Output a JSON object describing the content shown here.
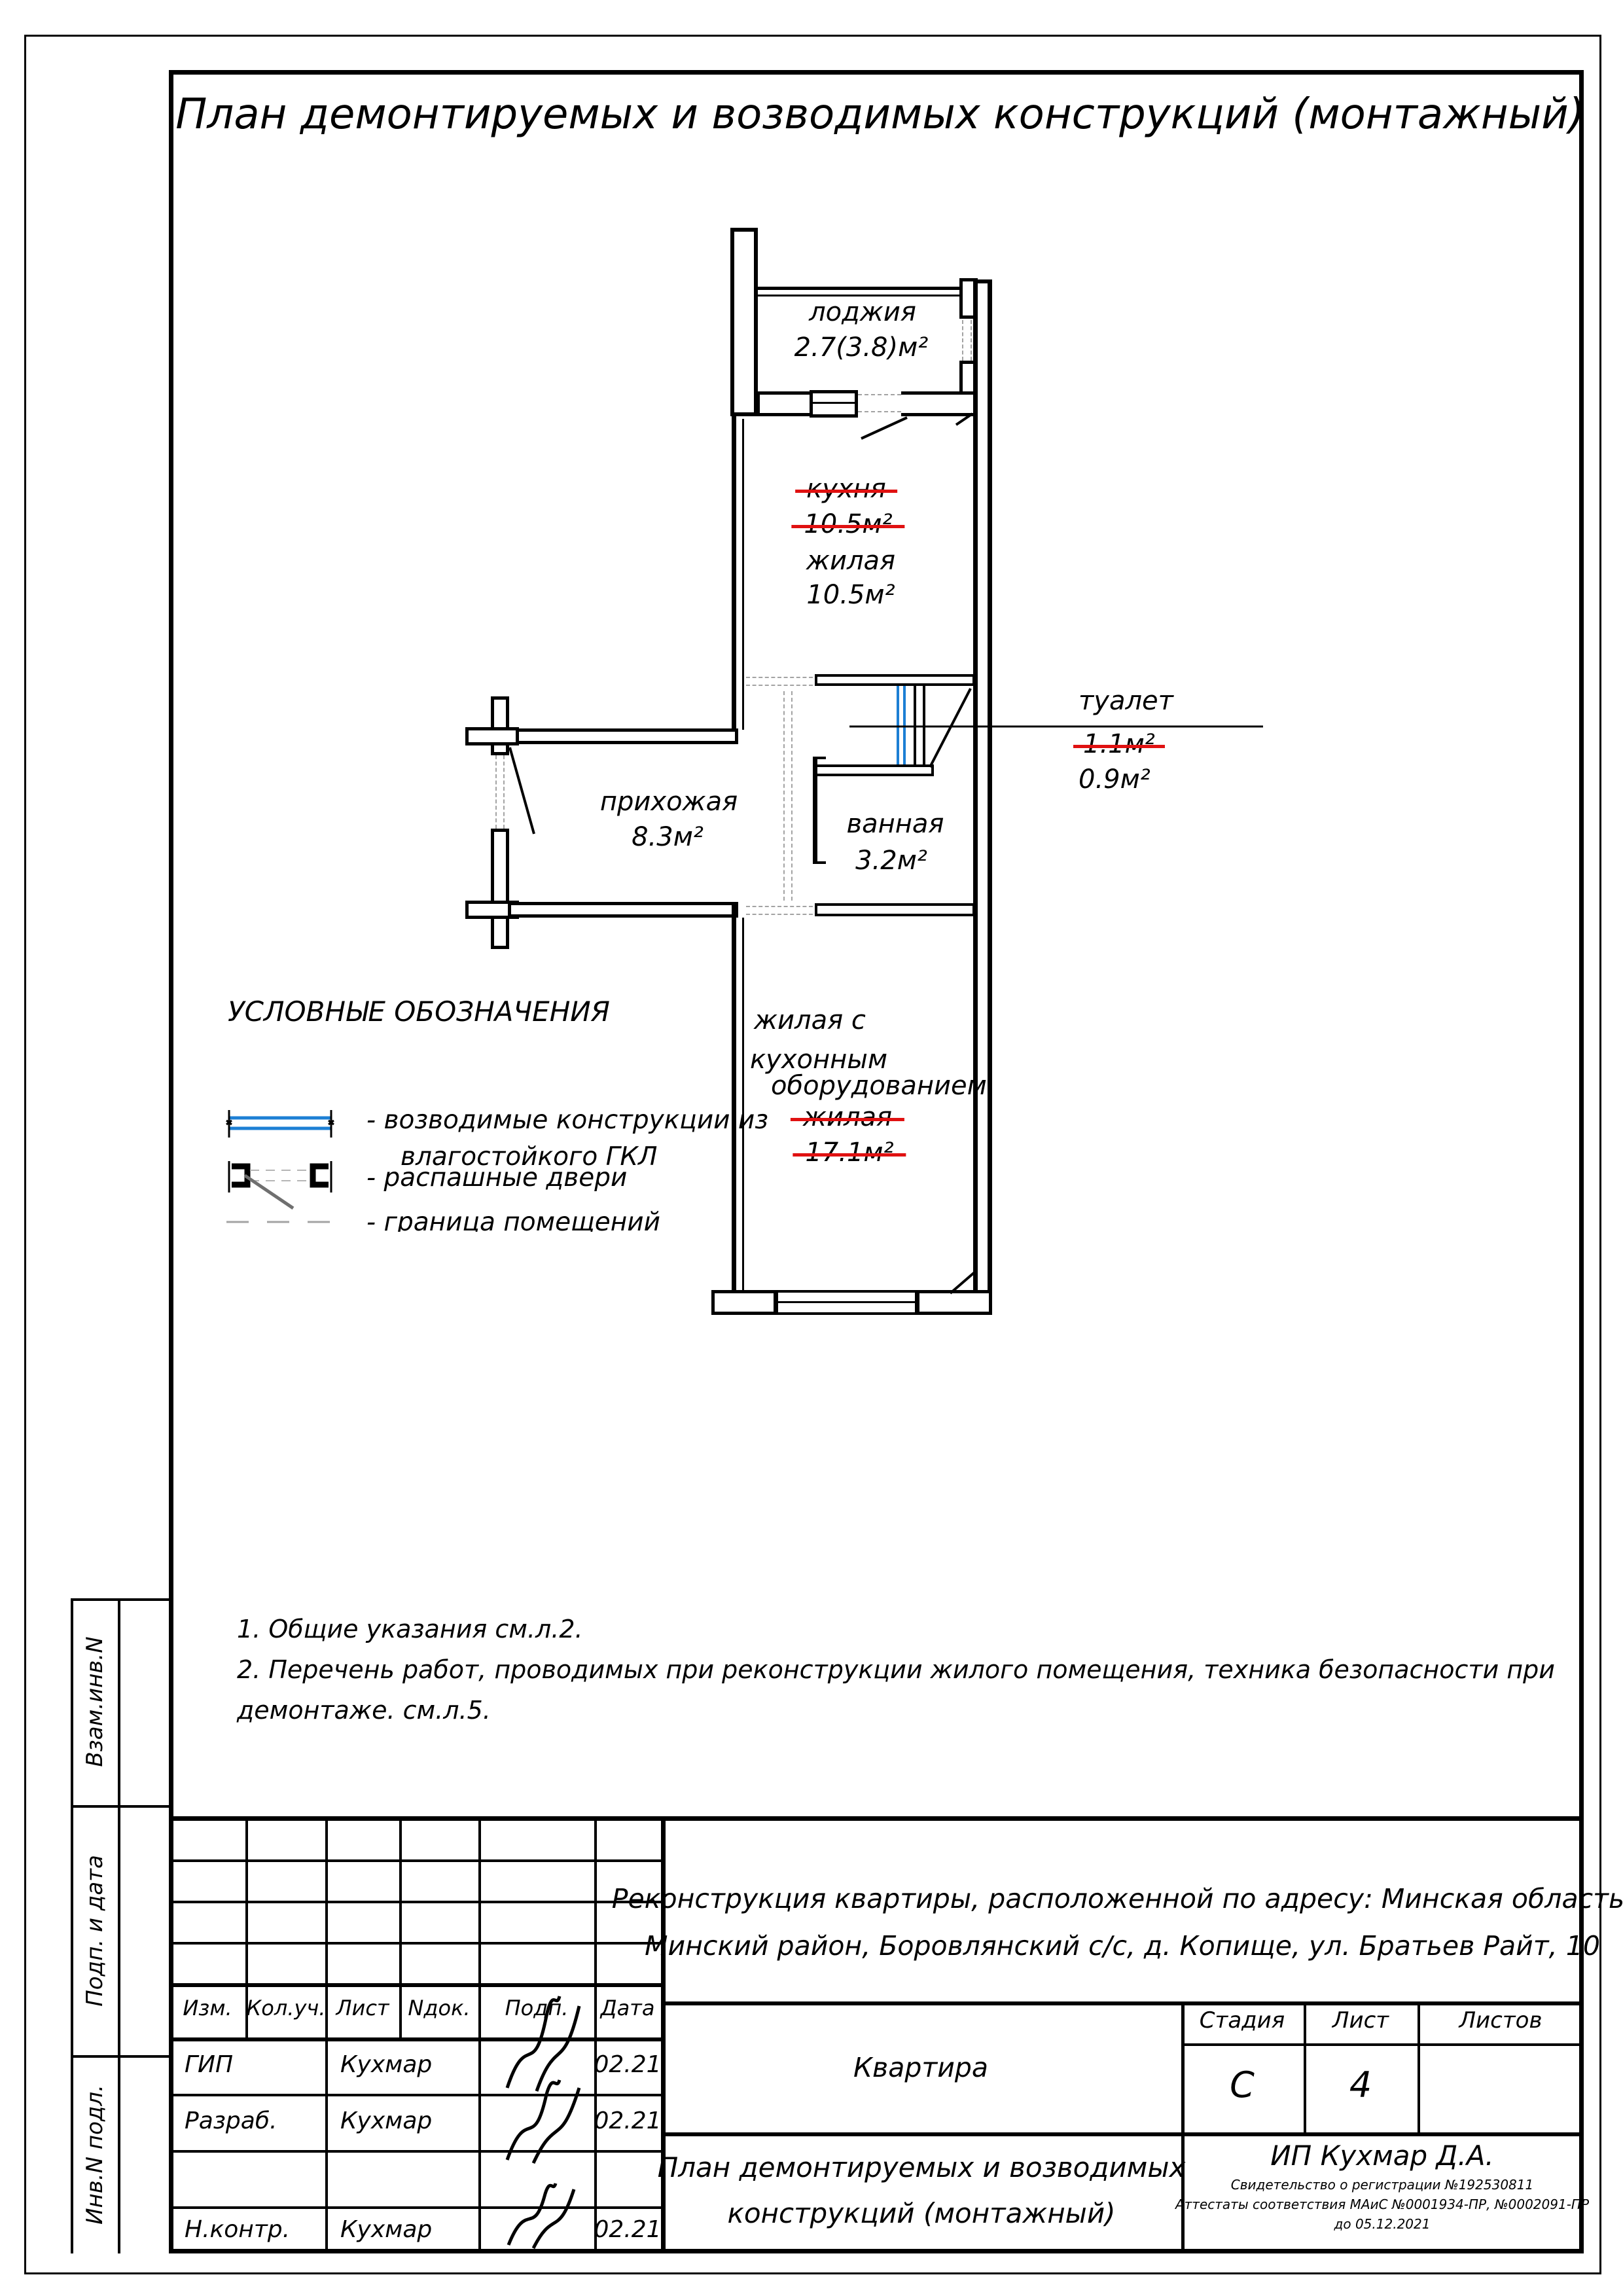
{
  "title": "План демонтируемых и возводимых конструкций (монтажный)",
  "plan": {
    "rooms": {
      "loggia": {
        "name": "лоджия",
        "area": "2.7(3.8)м²"
      },
      "kitchen_old": {
        "name": "кухня",
        "area": "10.5м²"
      },
      "living_new": {
        "name": "жилая",
        "area": "10.5м²"
      },
      "toilet": {
        "name": "туалет",
        "area_old": "1.1м²",
        "area_new": "0.9м²"
      },
      "bathroom": {
        "name": "ванная",
        "area": "3.2м²"
      },
      "hallway": {
        "name": "прихожая",
        "area": "8.3м²"
      },
      "living_kitchen": {
        "name_line1": "жилая с",
        "name_line2": "кухонным",
        "name_line3": "оборудованием",
        "old_name": "жилая",
        "old_area": "17.1м²"
      }
    }
  },
  "legend": {
    "header": "УСЛОВНЫЕ ОБОЗНАЧЕНИЯ",
    "item1_line1": "- возводимые конструкции из",
    "item1_line2": "влагостойкого ГКЛ",
    "item2": "- распашные двери",
    "item3": "- граница помещений"
  },
  "notes": {
    "line1": "1. Общие указания см.л.2.",
    "line2": "2. Перечень работ, проводимых при реконструкции жилого помещения, техника безопасности при",
    "line3": "демонтаже. см.л.5."
  },
  "sidebar": {
    "labels": [
      "Взам.инв.N",
      "Подп. и дата",
      "Инв.N подл."
    ]
  },
  "titleblock": {
    "header_cols": [
      "Изм.",
      "Кол.уч.",
      "Лист",
      "Nдок.",
      "Подп.",
      "Дата"
    ],
    "rows": [
      {
        "role": "ГИП",
        "name": "Кухмар",
        "date": "02.21"
      },
      {
        "role": "Разраб.",
        "name": "Кухмар",
        "date": "02.21"
      },
      {
        "role": "Н.контр.",
        "name": "Кухмар",
        "date": "02.21"
      }
    ],
    "project_line1": "Реконструкция квартиры, расположенной по адресу: Минская область,",
    "project_line2": "Минский район, Боровлянский с/с, д. Копище, ул. Братьев Райт, 10",
    "object": "Квартира",
    "stage_label": "Стадия",
    "sheet_label": "Лист",
    "sheets_label": "Листов",
    "stage": "С",
    "sheet": "4",
    "sheets": "",
    "doc_line1": "План демонтируемых и возводимых",
    "doc_line2": "конструкций (монтажный)",
    "company": "ИП Кухмар Д.А.",
    "cert1": "Свидетельство о регистрации №192530811",
    "cert2": "Аттестаты соответствия МАиС №0001934-ПР, №0002091-ПР",
    "cert3": "до 05.12.2021"
  }
}
